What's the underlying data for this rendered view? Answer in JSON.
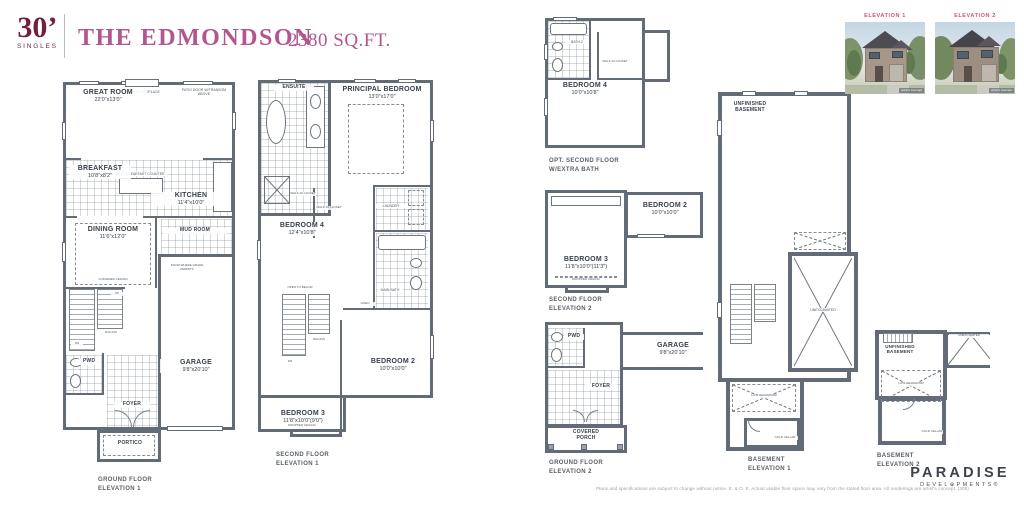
{
  "header": {
    "series": "30’",
    "series_sub": "SINGLES",
    "model_name": "THE EDMONDSON",
    "sqft": "2380 SQ.FT."
  },
  "elevation_photos": [
    {
      "label": "ELEVATION 1",
      "credit": "Artist's Concept"
    },
    {
      "label": "ELEVATION 2",
      "credit": "Artist's Concept"
    }
  ],
  "plans": {
    "ground1": {
      "caption": [
        "GROUND FLOOR",
        "ELEVATION 1"
      ],
      "rooms": {
        "great_room": {
          "name": "GREAT ROOM",
          "dims": "22'0\"x13'0\""
        },
        "breakfast": {
          "name": "BREAKFAST",
          "dims": "10'8\"x8'2\""
        },
        "kitchen": {
          "name": "KITCHEN",
          "dims": "11'4\"x10'0\""
        },
        "dining_room": {
          "name": "DINING ROOM",
          "dims": "11'6\"x12'0\""
        },
        "mud_room": {
          "name": "MUD ROOM"
        },
        "pwd": {
          "name": "PWD"
        },
        "garage": {
          "name": "GARAGE",
          "dims": "9'8\"x20'10\""
        },
        "foyer": {
          "name": "FOYER"
        },
        "portico": {
          "name": "PORTICO"
        }
      },
      "notes": {
        "fireplace": "ELECTRIC FIREPLACE",
        "patio_door": "PATIO DOOR W/TRANSOM ABOVE",
        "island": "EXT. BREAKFAST COUNTER",
        "coffered": "COFFERED CEILING",
        "grade_door": "DOOR WHERE GRADE PERMITS",
        "up": "UP",
        "dn": "DN",
        "railing": "RAILING"
      }
    },
    "second1": {
      "caption": [
        "SECOND FLOOR",
        "ELEVATION 1"
      ],
      "rooms": {
        "ensuite": {
          "name": "ENSUITE"
        },
        "principal": {
          "name": "PRINCIPAL BEDROOM",
          "dims": "13'0\"x17'0\""
        },
        "bedroom4": {
          "name": "BEDROOM 4",
          "dims": "12'4\"x10'8\""
        },
        "laundry": {
          "name": "LAUNDRY"
        },
        "main_bath": {
          "name": "MAIN BATH"
        },
        "bedroom2": {
          "name": "BEDROOM 2",
          "dims": "10'0\"x10'0\""
        },
        "bedroom3": {
          "name": "BEDROOM 3",
          "dims": "11'8\"x10'0\"(9'0\")"
        }
      },
      "notes": {
        "wic1": "WALK-IN CLOSET",
        "wic2": "WALK-IN CLOSET",
        "linen": "LINEN",
        "open_below": "OPEN TO BELOW",
        "railing": "RAILING",
        "dn": "DN",
        "dropped": "DROPPED CEILING"
      }
    },
    "opt_second": {
      "caption": [
        "OPT. SECOND FLOOR",
        "W/EXTRA BATH"
      ],
      "rooms": {
        "bath2": {
          "name": "BATH 2"
        },
        "bedroom4": {
          "name": "BEDROOM 4",
          "dims": "10'0\"x10'8\""
        }
      },
      "notes": {
        "wic": "WALK-IN CLOSET"
      }
    },
    "second2": {
      "caption": [
        "SECOND FLOOR",
        "ELEVATION 2"
      ],
      "rooms": {
        "bedroom2": {
          "name": "BEDROOM 2",
          "dims": "10'0\"x10'0\""
        },
        "bedroom3": {
          "name": "BEDROOM 3",
          "dims": "11'8\"x10'0\"(11'3\")"
        }
      },
      "notes": {
        "dropped": "DROPPED CEILING"
      }
    },
    "ground2": {
      "caption": [
        "GROUND FLOOR",
        "ELEVATION 2"
      ],
      "rooms": {
        "pwd": {
          "name": "PWD"
        },
        "garage": {
          "name": "GARAGE",
          "dims": "9'8\"x20'10\""
        },
        "foyer": {
          "name": "FOYER"
        },
        "porch": {
          "name": "COVERED PORCH"
        }
      }
    },
    "basement1": {
      "caption": [
        "BASEMENT",
        "ELEVATION 1"
      ],
      "rooms": {
        "unfinished": {
          "name": "UNFINISHED BASEMENT"
        },
        "unexcavated": {
          "name": "UNEXCAVATED"
        },
        "cold_cellar": {
          "name": "COLD CELLAR"
        }
      },
      "notes": {
        "low_headroom": "LOW HEADROOM",
        "low_headroom2": "LOW HEADROOM"
      }
    },
    "basement2": {
      "caption": [
        "BASEMENT",
        "ELEVATION 2"
      ],
      "rooms": {
        "unfinished": {
          "name": "UNFINISHED BASEMENT"
        },
        "unexcavated": {
          "name": "UNEXCAVATED"
        },
        "cold_cellar": {
          "name": "COLD CELLAR"
        }
      },
      "notes": {
        "low_headroom": "LOW HEADROOM"
      }
    }
  },
  "footer": {
    "disclaimer": "Plans and specifications are subject to change without notice. E. & O. E.  Actual usable floor space may vary from the stated floor area. All renderings are artist's concept. (305)",
    "brand": "PARADISE",
    "brand_sub": "DEVEL⊕PMENTS®"
  }
}
